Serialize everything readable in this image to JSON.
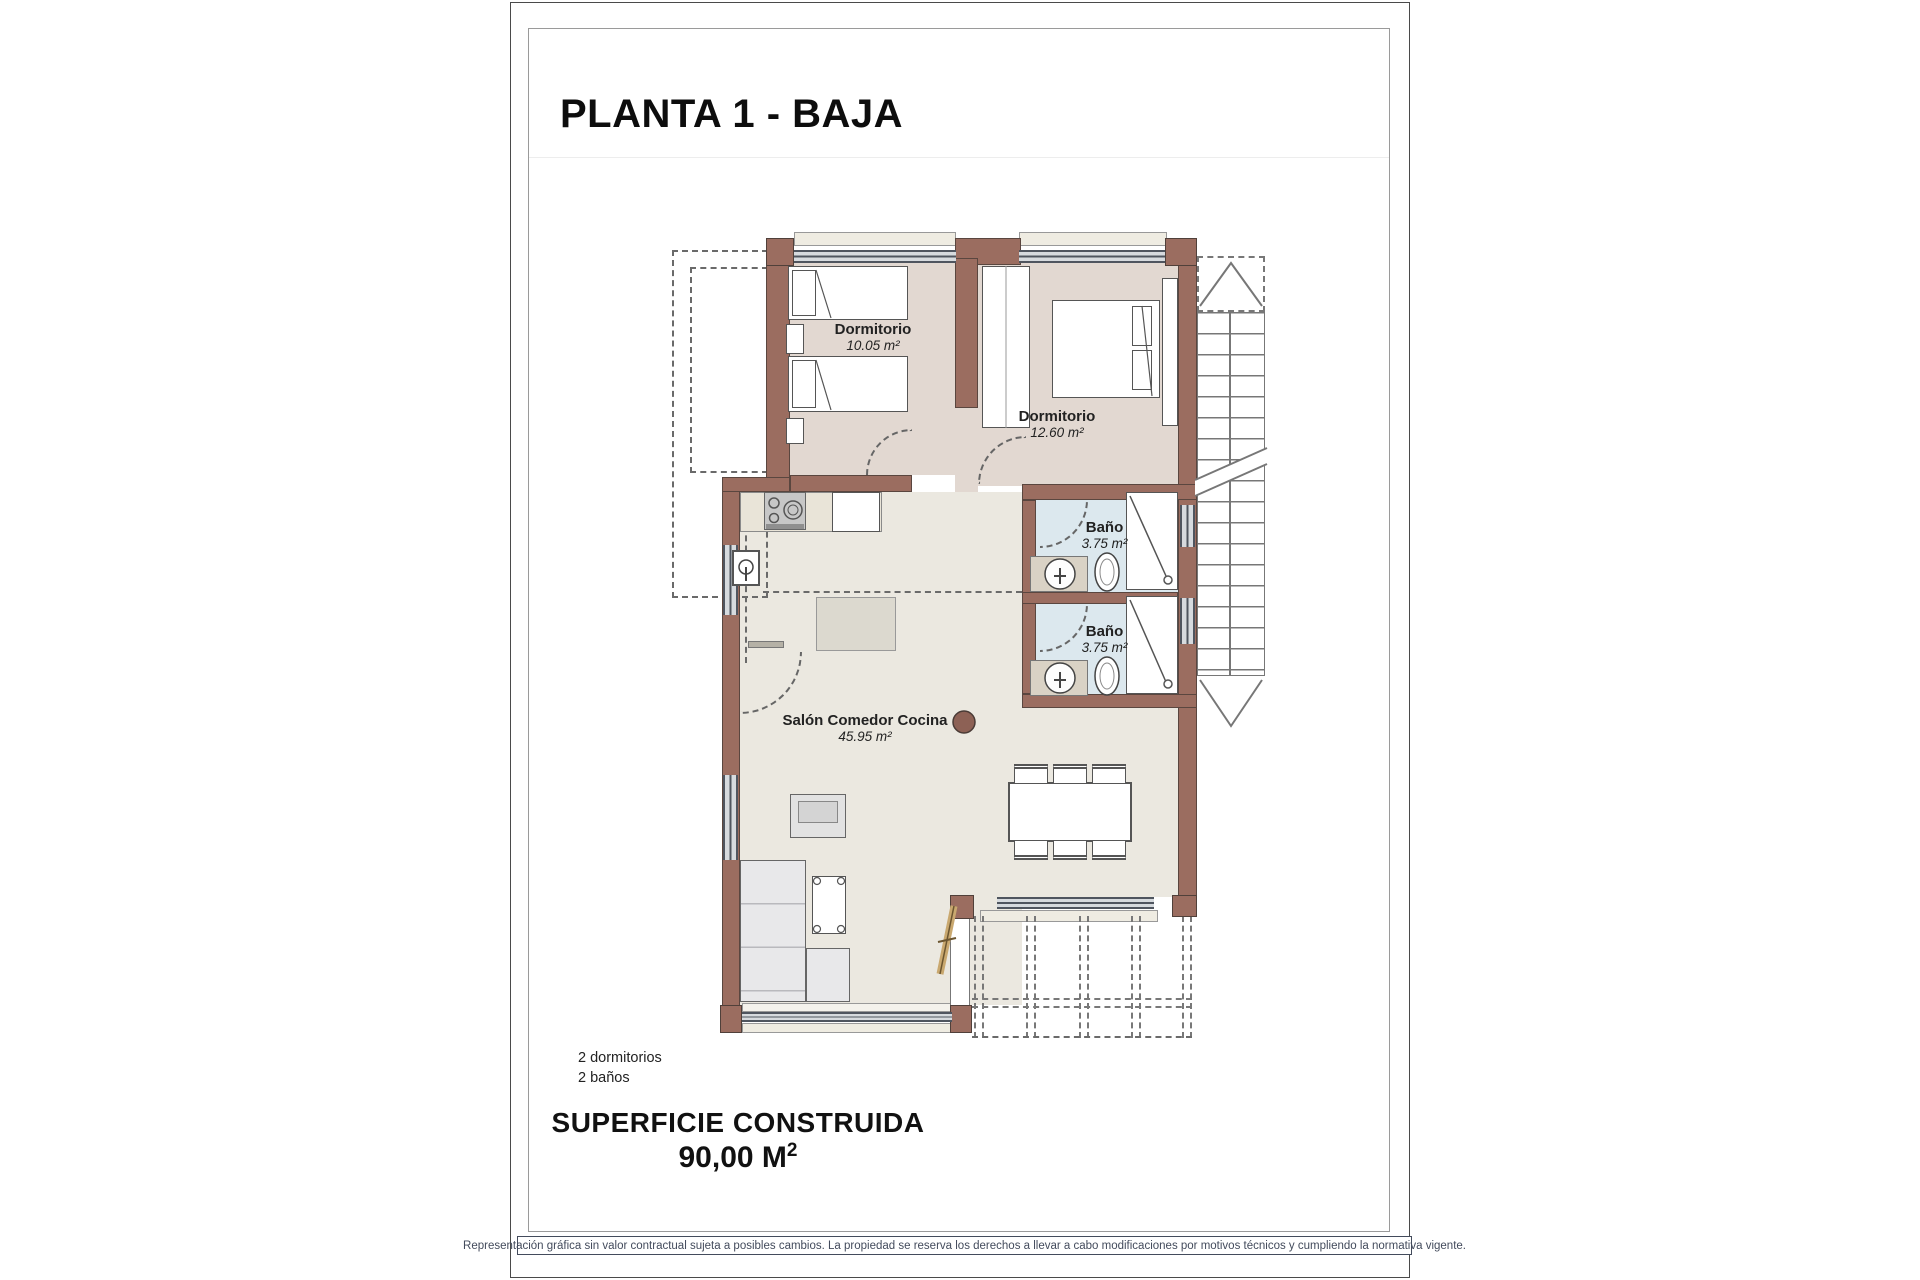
{
  "page": {
    "title": "PLANTA 1 - BAJA",
    "footer_disclaimer": "Representación gráfica sin valor contractual sujeta a posibles cambios. La propiedad se reserva los derechos a llevar a cabo modificaciones por motivos técnicos y cumpliendo la normativa vigente."
  },
  "rooms": [
    {
      "id": "dormitorio-1",
      "name": "Dormitorio",
      "area": "10.05 m²"
    },
    {
      "id": "dormitorio-2",
      "name": "Dormitorio",
      "area": "12.60 m²"
    },
    {
      "id": "bano-1",
      "name": "Baño",
      "area": "3.75 m²"
    },
    {
      "id": "bano-2",
      "name": "Baño",
      "area": "3.75 m²"
    },
    {
      "id": "salon",
      "name": "Salón Comedor Cocina",
      "area": "45.95 m²"
    }
  ],
  "summary": {
    "bedrooms": "2 dormitorios",
    "bathrooms": "2 baños"
  },
  "surface": {
    "label": "SUPERFICIE CONSTRUIDA",
    "value": "90,00 M",
    "sup": "2"
  },
  "colors": {
    "wall": "#9b6d60",
    "bedroomFloor": "#e2d8d1",
    "bathFloor": "#dce8ee",
    "salonFloor": "#ebe8e0",
    "frame": "#4a4a4a"
  }
}
